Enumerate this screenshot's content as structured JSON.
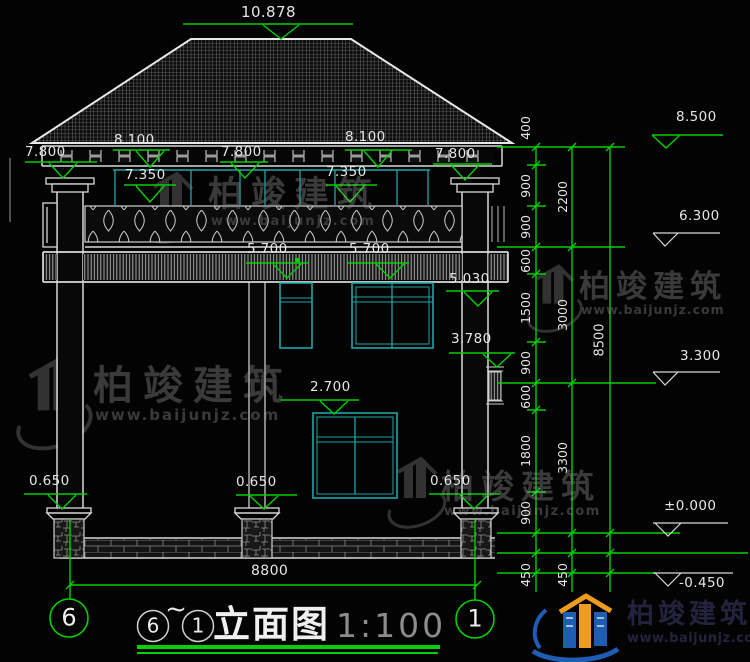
{
  "colors": {
    "background": "#030303",
    "linework": "#d9d9d9",
    "dimension_green": "#00d000",
    "window_cyan": "#1fa6a6",
    "watermark_gray": "#3a3a3a",
    "logo_blue": "#1d5eb4",
    "logo_orange": "#ee9e1b"
  },
  "dims": {
    "ridge_height": "10.878",
    "roof_top": [
      "8.100",
      "8.100"
    ],
    "eave": [
      "7.800",
      "7.800",
      "7.800"
    ],
    "upper_window_top": [
      "7.350",
      "7.350"
    ],
    "balcony_floor": [
      "5.700",
      "5.700"
    ],
    "window_head": "5.030",
    "vent_top": "3.780",
    "window_top": "2.700",
    "plinth_top": [
      "0.650",
      "0.650",
      "0.650"
    ],
    "total_width": "8800"
  },
  "levels": {
    "eave": "8.500",
    "second_floor": "6.300",
    "first_floor": "3.300",
    "ground": "±0.000",
    "footing": "-0.450"
  },
  "chains": {
    "segments": [
      "400",
      "900",
      "900",
      "600",
      "1500",
      "900",
      "600",
      "1800",
      "900",
      "450",
      "450"
    ],
    "floors": [
      "2200",
      "3000",
      "3300"
    ],
    "total": "8500"
  },
  "axes": {
    "left": "6",
    "right": "1"
  },
  "title": {
    "from": "6",
    "tilde": "~",
    "to": "1",
    "name": "立面图",
    "scale": "1:100"
  },
  "watermark": {
    "brand": "柏竣建筑",
    "url": "www.baijunjz.com"
  }
}
